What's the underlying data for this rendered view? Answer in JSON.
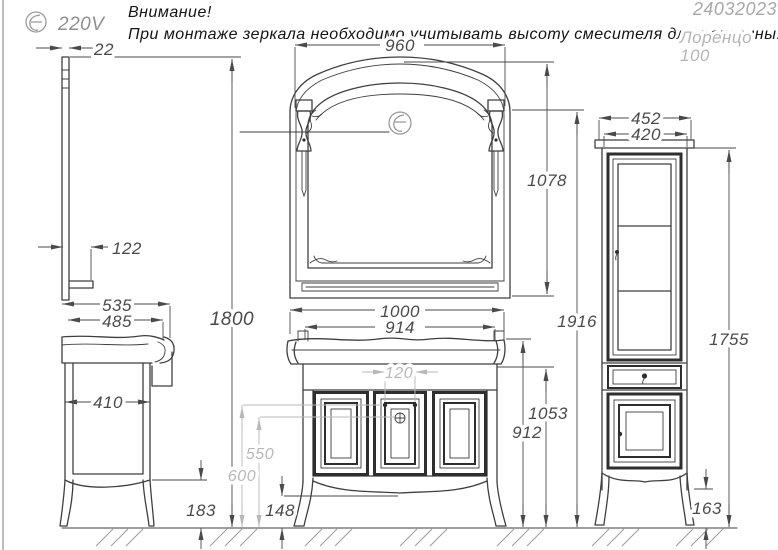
{
  "header": {
    "voltage": "220V",
    "warning_line1": "Внимание!",
    "warning_line2": "При монтаже зеркала необходимо учитывать высоту смесителя для раковины!",
    "date_code": "24032023",
    "model_name": "Лоренцо",
    "model_size": "100"
  },
  "dims": {
    "mirror_thickness": "22",
    "mirror_width": "960",
    "mirror_height": "1078",
    "mirror_shelf_depth": "122",
    "mirror_mount_height": "1800",
    "side_top_depth": "535",
    "side_body_depth": "485",
    "side_inner_depth": "410",
    "side_leg_height": "183",
    "vanity_width": "1000",
    "vanity_body_width": "914",
    "faucet_hole_spacing": "120",
    "drain_height": "550",
    "supply_height": "600",
    "vanity_leg_height": "148",
    "countertop_height": "1053",
    "vanity_body_height": "912",
    "total_height": "1916",
    "column_top_width": "452",
    "column_body_width": "420",
    "column_height": "1755",
    "column_leg_height": "163"
  },
  "colors": {
    "line": "#3f3f3f",
    "dim_text": "#4a4a4a",
    "gray_dim": "#b8b8b8",
    "muted": "#9a9a9a",
    "light_text": "#b5b5b5",
    "hatch": "#9c9c9c"
  }
}
